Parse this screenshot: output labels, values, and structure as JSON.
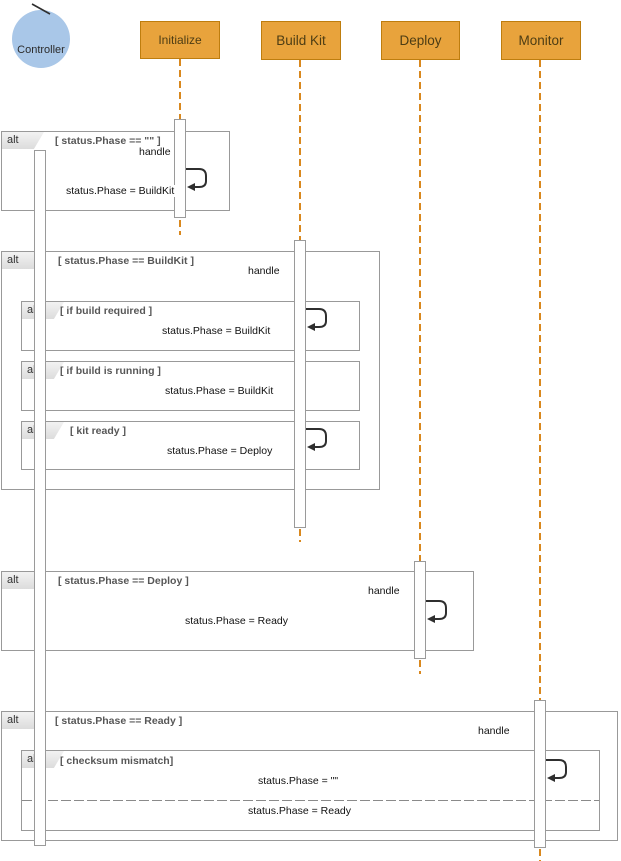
{
  "diagram": {
    "type": "uml-sequence",
    "actor": {
      "name": "Controller"
    },
    "participants": [
      {
        "label": "Initialize"
      },
      {
        "label": "Build Kit"
      },
      {
        "label": "Deploy"
      },
      {
        "label": "Monitor"
      }
    ],
    "fragments": [
      {
        "operator": "alt",
        "guard": "[ status.Phase == \"\" ]"
      },
      {
        "operator": "alt",
        "guard": "[ status.Phase == BuildKit ]"
      },
      {
        "operator": "alt",
        "guard": "[ if build required ]"
      },
      {
        "operator": "alt",
        "guard": "[ if build is running ]"
      },
      {
        "operator": "alt",
        "guard": "[ kit ready ]"
      },
      {
        "operator": "alt",
        "guard": "[ status.Phase == Deploy ]"
      },
      {
        "operator": "alt",
        "guard": "[ status.Phase == Ready ]"
      },
      {
        "operator": "alt",
        "guard": "[ checksum mismatch]"
      }
    ],
    "messages": [
      {
        "text": "handle"
      },
      {
        "text": "status.Phase = BuildKit"
      },
      {
        "text": "handle"
      },
      {
        "text": "status.Phase = BuildKit"
      },
      {
        "text": "status.Phase = BuildKit"
      },
      {
        "text": "status.Phase = Deploy"
      },
      {
        "text": "handle"
      },
      {
        "text": "status.Phase = Ready"
      },
      {
        "text": "handle"
      },
      {
        "text": "status.Phase = \"\""
      },
      {
        "text": "status.Phase = Ready"
      }
    ]
  },
  "colors": {
    "participant_fill": "#E8A33C",
    "participant_border": "#BE7D0E",
    "lifeline": "#D9881E",
    "actor_fill": "#A9C7E8",
    "fragment_border": "#999999",
    "guard_text": "#575757",
    "message_text": "#111111",
    "arrow": "#2f2f2f"
  }
}
